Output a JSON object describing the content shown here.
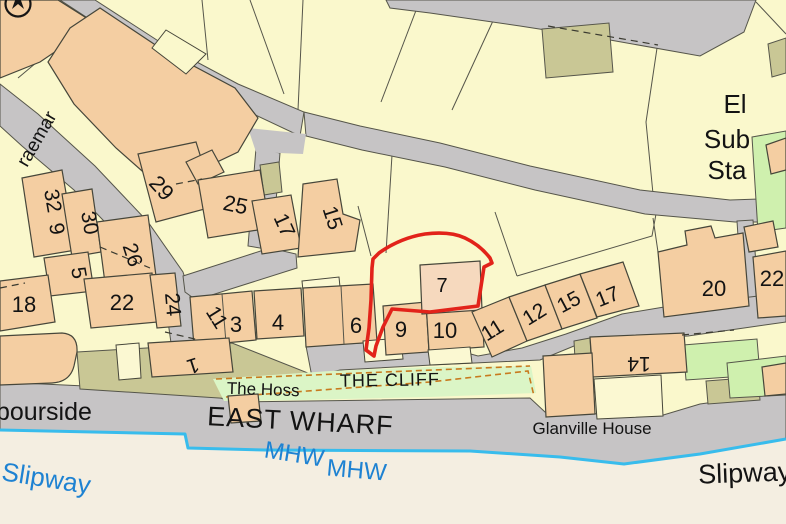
{
  "map_labels": {
    "el": "El",
    "sub": "Sub",
    "sta": "Sta",
    "braemar_partial": "raemar",
    "harbourside_partial": "bourside",
    "east_wharf": "EAST WHARF",
    "the_hoss": "The Hoss",
    "the_cliff": "THE CLIFF",
    "glanville_house": "Glanville House",
    "mhw_first": "MHW",
    "mhw_second": "MHW",
    "slipway_blue": "Slipway",
    "slipway_black": "Slipway"
  },
  "house_numbers": {
    "n32": "32",
    "n9_left": "9",
    "n30": "30",
    "n26": "26",
    "n5": "5",
    "n18": "18",
    "n22_left": "22",
    "n24": "24",
    "n29": "29",
    "n25": "25",
    "n17_left": "17",
    "n15_left": "15",
    "n11_left": "11",
    "n3": "3",
    "n4": "4",
    "n1": "1",
    "n6": "6",
    "n9_mid": "9",
    "n10": "10",
    "n7": "7",
    "n11_right": "11",
    "n12": "12",
    "n15_right": "15",
    "n17_right": "17",
    "n20": "20",
    "n22_right": "22",
    "n14": "14"
  },
  "highlight": {
    "parcel_number": "7",
    "outline_color": "#e2231a"
  },
  "colors": {
    "parcel_yellow": "#faf8cc",
    "building_peach": "#f4cea2",
    "highlight_parcel_fill": "#f6d9be",
    "road_gray": "#c6c4c5",
    "vegetation_green": "#cff0ae",
    "cliff_green": "#dbf5c6",
    "scrub_olive": "#c9c795",
    "beach_cream": "#f4eee1",
    "water_line_blue": "#38bcec",
    "water_text_blue": "#1e82d2",
    "boundary_red": "#e2231a"
  }
}
